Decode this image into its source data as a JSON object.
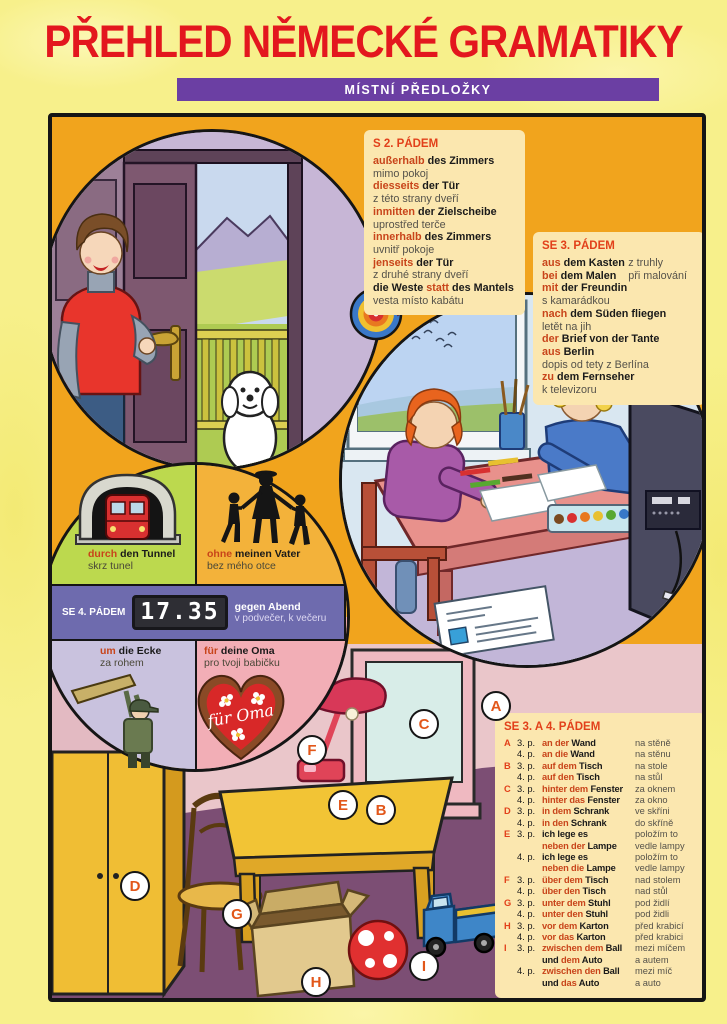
{
  "title": "PŘEHLED NĚMECKÉ GRAMATIKY",
  "banner": "MÍSTNÍ PŘEDLOŽKY",
  "colors": {
    "title_red": "#E3171E",
    "banner_purple": "#6B3FA3",
    "panel_orange": "#F1A41D",
    "box_cream": "#FBE7AF",
    "preposition_red": "#C8441A",
    "band_purple": "#6E6BAE"
  },
  "s2": {
    "heading": "S 2. PÁDEM",
    "lines": [
      {
        "s": [
          [
            "außerhalb",
            "p"
          ],
          [
            " des Zimmers",
            "g"
          ]
        ]
      },
      {
        "s": [
          [
            "mimo pokoj",
            "c"
          ]
        ]
      },
      {
        "s": [
          [
            "diesseits",
            "p"
          ],
          [
            " der Tür",
            "g"
          ]
        ]
      },
      {
        "s": [
          [
            "z této strany dveří",
            "c"
          ]
        ]
      },
      {
        "s": [
          [
            "inmitten",
            "p"
          ],
          [
            " der Zielscheibe",
            "g"
          ]
        ]
      },
      {
        "s": [
          [
            "uprostřed terče",
            "c"
          ]
        ]
      },
      {
        "s": [
          [
            "innerhalb",
            "p"
          ],
          [
            " des Zimmers",
            "g"
          ]
        ]
      },
      {
        "s": [
          [
            "uvnitř pokoje",
            "c"
          ]
        ]
      },
      {
        "s": [
          [
            "jenseits",
            "p"
          ],
          [
            " der Tür",
            "g"
          ]
        ]
      },
      {
        "s": [
          [
            "z druhé strany dveří",
            "c"
          ]
        ]
      },
      {
        "s": [
          [
            "die Weste ",
            "g"
          ],
          [
            "statt",
            "p"
          ],
          [
            " des Mantels",
            "g"
          ]
        ]
      },
      {
        "s": [
          [
            "vesta místo kabátu",
            "c"
          ]
        ]
      }
    ]
  },
  "se3": {
    "heading": "SE 3. PÁDEM",
    "lines": [
      {
        "s": [
          [
            "aus",
            "p"
          ],
          [
            " dem Kasten",
            "g"
          ]
        ],
        "r": "z truhly"
      },
      {
        "s": [
          [
            "bei",
            "p"
          ],
          [
            " dem Malen",
            "g"
          ]
        ],
        "r": "při malování"
      },
      {
        "s": [
          [
            "mit",
            "p"
          ],
          [
            " der Freundin",
            "g"
          ]
        ]
      },
      {
        "s": [
          [
            "s kamarádkou",
            "c"
          ]
        ]
      },
      {
        "s": [
          [
            "nach",
            "p"
          ],
          [
            " dem Süden fliegen",
            "g"
          ]
        ]
      },
      {
        "s": [
          [
            "letět na jih",
            "c"
          ]
        ]
      },
      {
        "s": [
          [
            "der",
            "p"
          ],
          [
            " Brief von der Tante",
            "g"
          ]
        ]
      },
      {
        "s": [
          [
            "aus",
            "p"
          ],
          [
            " Berlin",
            "g"
          ]
        ]
      },
      {
        "s": [
          [
            "dopis od tety z Berlína",
            "c"
          ]
        ]
      },
      {
        "s": [
          [
            "zu",
            "p"
          ],
          [
            " dem Fernseher",
            "g"
          ]
        ]
      },
      {
        "s": [
          [
            "k televizoru",
            "c"
          ]
        ]
      }
    ]
  },
  "se4": {
    "heading": "SE 4. PÁDEM",
    "clock_time": "17.35",
    "band_de": "gegen Abend",
    "band_cz": "v podvečer, k večeru",
    "heart_text": "für Oma",
    "quads": [
      {
        "seg": [
          [
            "durch",
            "p"
          ],
          [
            " den Tunnel",
            "g"
          ]
        ],
        "cz": "skrz tunel"
      },
      {
        "seg": [
          [
            "ohne",
            "p"
          ],
          [
            " meinen Vater",
            "g"
          ]
        ],
        "cz": "bez mého otce"
      },
      {
        "seg": [
          [
            "um",
            "p"
          ],
          [
            " die Ecke",
            "g"
          ]
        ],
        "cz": "za rohem"
      },
      {
        "seg": [
          [
            "für",
            "p"
          ],
          [
            " deine Oma",
            "g"
          ]
        ],
        "cz": "pro tvoji babičku"
      }
    ]
  },
  "se34": {
    "heading": "SE 3. A 4. PÁDEM",
    "rows": [
      {
        "l": "A",
        "c": "3. p.",
        "s": [
          [
            "an der",
            "p"
          ],
          [
            " Wand",
            "g"
          ]
        ],
        "r": "na stěně"
      },
      {
        "l": "",
        "c": "4. p.",
        "s": [
          [
            "an die",
            "p"
          ],
          [
            " Wand",
            "g"
          ]
        ],
        "r": "na stěnu"
      },
      {
        "l": "B",
        "c": "3. p.",
        "s": [
          [
            "auf dem",
            "p"
          ],
          [
            " Tisch",
            "g"
          ]
        ],
        "r": "na stole"
      },
      {
        "l": "",
        "c": "4. p.",
        "s": [
          [
            "auf den",
            "p"
          ],
          [
            " Tisch",
            "g"
          ]
        ],
        "r": "na stůl"
      },
      {
        "l": "C",
        "c": "3. p.",
        "s": [
          [
            "hinter dem",
            "p"
          ],
          [
            " Fenster",
            "g"
          ]
        ],
        "r": "za oknem"
      },
      {
        "l": "",
        "c": "4. p.",
        "s": [
          [
            "hinter das",
            "p"
          ],
          [
            " Fenster",
            "g"
          ]
        ],
        "r": "za okno"
      },
      {
        "l": "D",
        "c": "3. p.",
        "s": [
          [
            "in dem",
            "p"
          ],
          [
            " Schrank",
            "g"
          ]
        ],
        "r": "ve skříni"
      },
      {
        "l": "",
        "c": "4. p.",
        "s": [
          [
            "in den",
            "p"
          ],
          [
            " Schrank",
            "g"
          ]
        ],
        "r": "do skříně"
      },
      {
        "l": "E",
        "c": "3. p.",
        "s": [
          [
            "ich lege es",
            "g"
          ]
        ],
        "r": "položím to"
      },
      {
        "l": "",
        "c": "",
        "s": [
          [
            "neben der",
            "p"
          ],
          [
            " Lampe",
            "g"
          ]
        ],
        "r": "vedle lampy"
      },
      {
        "l": "",
        "c": "4. p.",
        "s": [
          [
            "ich lege es",
            "g"
          ]
        ],
        "r": "položím to"
      },
      {
        "l": "",
        "c": "",
        "s": [
          [
            "neben die",
            "p"
          ],
          [
            " Lampe",
            "g"
          ]
        ],
        "r": "vedle lampy"
      },
      {
        "l": "F",
        "c": "3. p.",
        "s": [
          [
            "über dem",
            "p"
          ],
          [
            " Tisch",
            "g"
          ]
        ],
        "r": "nad stolem"
      },
      {
        "l": "",
        "c": "4. p.",
        "s": [
          [
            "über den",
            "p"
          ],
          [
            " Tisch",
            "g"
          ]
        ],
        "r": "nad stůl"
      },
      {
        "l": "G",
        "c": "3. p.",
        "s": [
          [
            "unter dem",
            "p"
          ],
          [
            " Stuhl",
            "g"
          ]
        ],
        "r": "pod židlí"
      },
      {
        "l": "",
        "c": "4. p.",
        "s": [
          [
            "unter den",
            "p"
          ],
          [
            " Stuhl",
            "g"
          ]
        ],
        "r": "pod židli"
      },
      {
        "l": "H",
        "c": "3. p.",
        "s": [
          [
            "vor dem",
            "p"
          ],
          [
            " Karton",
            "g"
          ]
        ],
        "r": "před krabicí"
      },
      {
        "l": "",
        "c": "4. p.",
        "s": [
          [
            "vor das",
            "p"
          ],
          [
            " Karton",
            "g"
          ]
        ],
        "r": "před krabici"
      },
      {
        "l": "I",
        "c": "3. p.",
        "s": [
          [
            "zwischen dem",
            "p"
          ],
          [
            " Ball",
            "g"
          ]
        ],
        "r": "mezi míčem"
      },
      {
        "l": "",
        "c": "",
        "s": [
          [
            "und ",
            "g"
          ],
          [
            "dem",
            "p"
          ],
          [
            " Auto",
            "g"
          ]
        ],
        "r": "a autem"
      },
      {
        "l": "",
        "c": "4. p.",
        "s": [
          [
            "zwischen den",
            "p"
          ],
          [
            " Ball",
            "g"
          ]
        ],
        "r": "mezi míč"
      },
      {
        "l": "",
        "c": "",
        "s": [
          [
            "und ",
            "g"
          ],
          [
            "das",
            "p"
          ],
          [
            " Auto",
            "g"
          ]
        ],
        "r": "a auto"
      }
    ]
  },
  "letters": [
    "A",
    "B",
    "C",
    "D",
    "E",
    "F",
    "G",
    "H",
    "I"
  ]
}
